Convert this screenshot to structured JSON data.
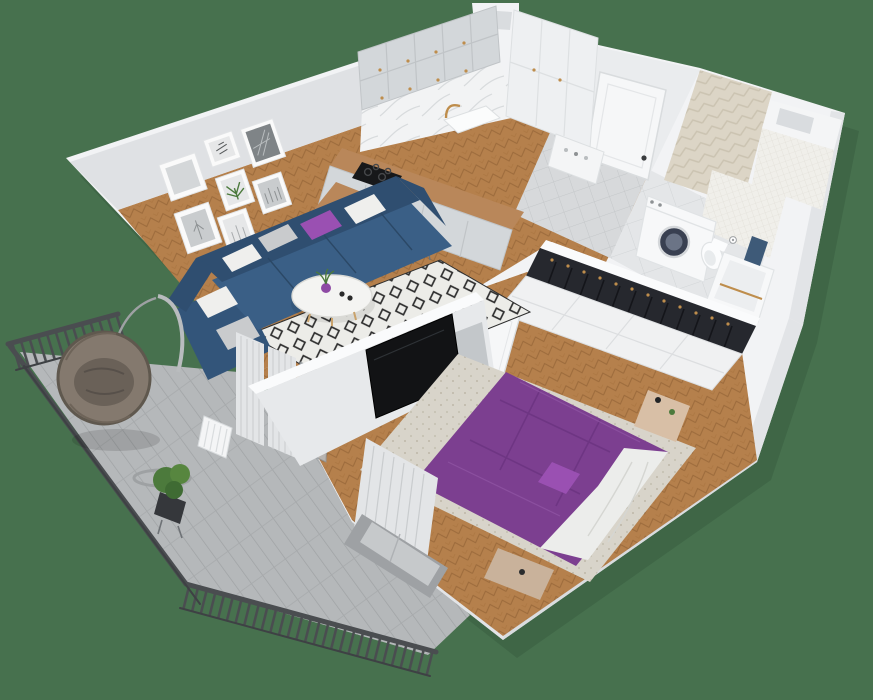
{
  "scene": {
    "description": "isometric-3d-cutaway-apartment-floorplan-render",
    "width": 873,
    "height": 700
  },
  "colors": {
    "background": "#47714E",
    "shadow": "#32523A",
    "wall_white": "#F2F3F5",
    "wall_shade": "#E2E4E7",
    "wall_shade2": "#D9DCDF",
    "wall_face": "#DFE1E4",
    "entry_wall": "#EAECEE",
    "inner_band": "#FAFBFC",
    "wood_floor": "#B5804C",
    "wood_line": "#9C6B3C",
    "wood_counter": "#B9875A",
    "tile_entry": "#D7D9DB",
    "tile_entry_line": "#C4C7C9",
    "tile_bath": "#E4E6E8",
    "tile_bath_line": "#D2D5D7",
    "tile_balcony": "#B5B8BA",
    "tile_balcony_line": "#9FA2A4",
    "railing": "#4A4D50",
    "cabinet_gray": "#D3D7DA",
    "cabinet_line": "#C0C4C7",
    "cabinet_tall": "#EEF0F2",
    "brass": "#BE8D4C",
    "marble": "#F2F3F4",
    "marble_vein": "#D8DBDD",
    "sink_white": "#FBFCFC",
    "cooktop_black": "#17181A",
    "oven_black": "#232527",
    "island_white": "#F4F5F6",
    "chair_gray": "#AEB2B6",
    "chair_leg": "#6E7276",
    "sofa_blue": "#3A5F86",
    "sofa_blue_dark": "#2F4E70",
    "sofa_chaise": "#33557A",
    "pillow_white": "#EFEFED",
    "pillow_gray": "#C9CBCD",
    "pillow_purple": "#9A50B2",
    "rug_cream": "#ECECE8",
    "rug_diamond": "#2E2E2E",
    "coffee_table": "#F4F4F2",
    "vase_purple": "#8E4AA4",
    "plant_green": "#4C7A3C",
    "plant_green2": "#57863F",
    "apple_green": "#68B23A",
    "tv_black": "#121315",
    "media_panel": "#C3C7CA",
    "divider_face": "#E7E9EB",
    "bed_purple": "#7C3F90",
    "bed_fold": "#6A3380",
    "duvet_white": "#ECEDEB",
    "duvet_line": "#D5D6D2",
    "bed_rug": "#D8D4CA",
    "bed_rug_dot": "#C7C2B4",
    "nightstand_tan": "#D8BFA6",
    "bench_tan": "#C9B29B",
    "door_white": "#F6F7F8",
    "door_line": "#D9DCDE",
    "handle_dark": "#3A3C3E",
    "clothes_dark": "#26282E",
    "clothes_line": "#14151A",
    "wardrobe_white": "#F0F1F2",
    "wardrobe_line": "#DCDEE0",
    "accent_tan": "#DCD5C6",
    "accent_line": "#CBC3B1",
    "penny_tile": "#F0EFEA",
    "penny_line": "#DEDCD4",
    "washer_white": "#F7F8F9",
    "washer_door": "#394051",
    "washer_door_inner": "#6B7486",
    "toilet_white": "#FBFCFD",
    "tub_white": "#F7F8F9",
    "tub_inner": "#ECEEF0",
    "towel_navy": "#3E5A78",
    "bath_mat": "#C6C9CB",
    "curtain": "#E3E5E7",
    "curtain_line": "#C9CCCE",
    "window_frame": "#9EA1A4",
    "window_glass": "#C6C9CB",
    "hang_chair": "#84796E",
    "hang_chair_dark": "#5F584E",
    "cushion_dark": "#6A6158",
    "stand_gray": "#B9BCBE",
    "pot_dark": "#35373B",
    "glass_door": "#B9BEC2",
    "radiator_white": "#F4F5F6",
    "frame_white": "#FAFAFA",
    "art_gray": "#C9CCCE",
    "art_gray2": "#D4D7D9",
    "art_light": "#E6E7E8",
    "art_dark": "#7F8487",
    "fixture_outline": "#E0E3E5"
  },
  "apartment": {
    "view": "top-down-isometric-cutaway",
    "rooms": [
      {
        "name": "living-room",
        "items": [
          "blue-corner-sofa",
          "white-pillows",
          "gray-pillows",
          "purple-pillow",
          "round-coffee-table",
          "purple-vase",
          "diamond-pattern-rug",
          "gallery-wall-seven-frames",
          "sheer-curtains",
          "radiator",
          "balcony-door"
        ]
      },
      {
        "name": "kitchen-dining",
        "items": [
          "upper-cabinets",
          "base-cabinets",
          "induction-cooktop",
          "oven",
          "farmhouse-sink",
          "brass-faucet",
          "marble-backsplash",
          "wood-breakfast-island",
          "dining-chairs",
          "plate-of-green-apples",
          "tall-pantry-cabinet"
        ]
      },
      {
        "name": "entry-hall",
        "items": [
          "front-door",
          "shoe-console",
          "gray-tile-floor",
          "ventilation-chimney"
        ]
      },
      {
        "name": "bathroom",
        "items": [
          "washing-machine",
          "toilet",
          "toilet-paper-holder",
          "bathtub",
          "navy-towel",
          "herringbone-accent-wall",
          "penny-tile-wall",
          "tiled-duct-shaft",
          "bath-mat"
        ]
      },
      {
        "name": "bedroom",
        "items": [
          "double-bed-purple-bedding",
          "white-duvet",
          "purple-pillow",
          "melange-area-rug",
          "wall-mounted-tv",
          "media-wall-panel",
          "wardrobe-row-with-hanging-clothes",
          "nightstand",
          "foot-bench",
          "window-with-curtains",
          "interior-door"
        ]
      },
      {
        "name": "balcony",
        "items": [
          "dark-metal-railing",
          "hanging-egg-chair",
          "chair-stand",
          "potted-plant",
          "gray-plank-tile-floor"
        ]
      }
    ]
  }
}
